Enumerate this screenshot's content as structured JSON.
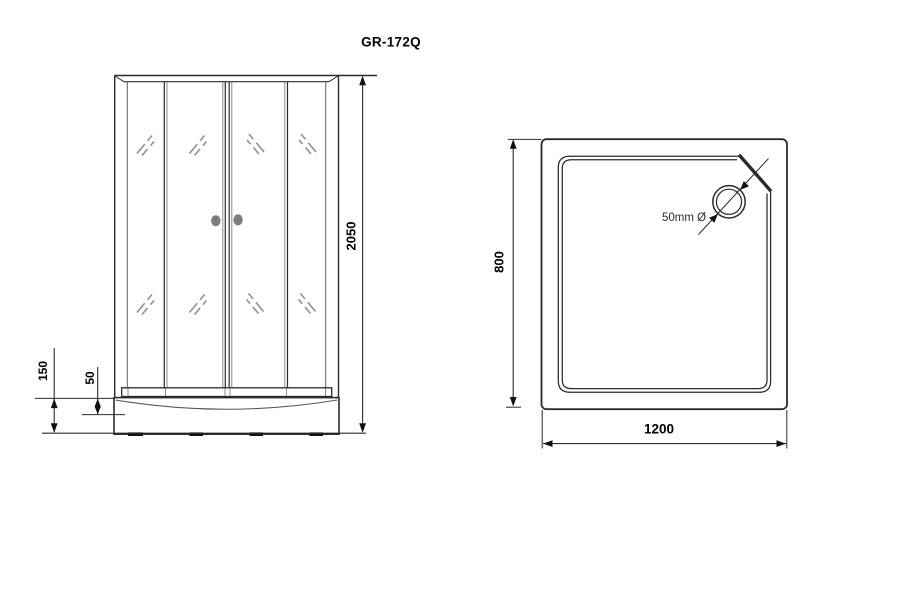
{
  "title": "GR-172Q",
  "front_view": {
    "dimensions": {
      "overall_height_mm": "2050",
      "tray_height_mm": "150",
      "rim_height_mm": "50"
    }
  },
  "top_view": {
    "dimensions": {
      "depth_mm": "800",
      "width_mm": "1200"
    },
    "drain": {
      "label": "50mm Ø"
    }
  },
  "colors": {
    "main_line": "#2b2b2b",
    "secondary_line": "#8c8c8c",
    "knob": "#7d7d7d",
    "feet": "#141414"
  }
}
